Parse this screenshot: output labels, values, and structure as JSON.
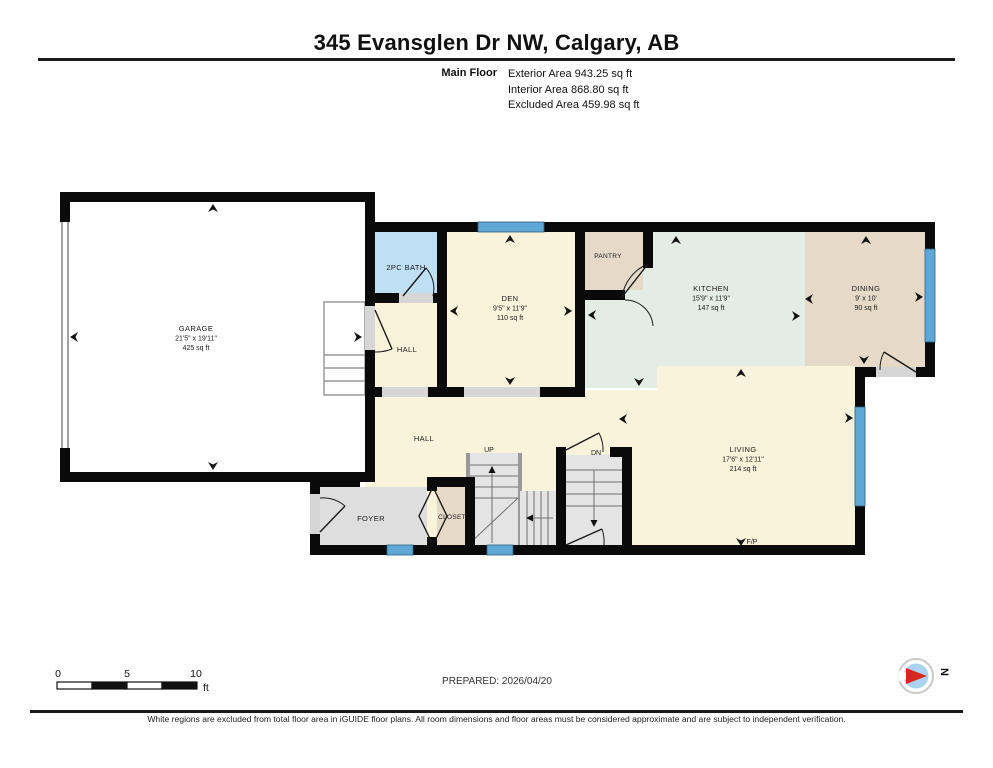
{
  "header": {
    "title": "345 Evansglen Dr NW, Calgary, AB",
    "floor_label": "Main Floor",
    "stats": [
      "Exterior Area 943.25 sq ft",
      "Interior Area 868.80 sq ft",
      "Excluded Area 459.98 sq ft"
    ]
  },
  "rooms": {
    "garage": {
      "name": "GARAGE",
      "dims": "21'5\" x 19'11\"",
      "area": "425 sq ft"
    },
    "bath": {
      "name": "2PC BATH"
    },
    "hall_upper": {
      "name": "HALL"
    },
    "den": {
      "name": "DEN",
      "dims": "9'5\" x 11'9\"",
      "area": "110 sq ft"
    },
    "pantry": {
      "name": "PANTRY"
    },
    "kitchen": {
      "name": "KITCHEN",
      "dims": "15'9\" x 11'9\"",
      "area": "147 sq ft"
    },
    "dining": {
      "name": "DINING",
      "dims": "9' x 10'",
      "area": "90 sq ft"
    },
    "living": {
      "name": "LIVING",
      "dims": "17'6\" x 12'11\"",
      "area": "214 sq ft"
    },
    "hall_lower": {
      "name": "HALL"
    },
    "foyer": {
      "name": "FOYER"
    },
    "closet": {
      "name": "CLOSET"
    },
    "stairs_up": {
      "name": "UP"
    },
    "stairs_dn": {
      "name": "DN"
    },
    "fireplace": {
      "name": "F/P"
    }
  },
  "scale_bar": {
    "tick0": "0",
    "tick5": "5",
    "tick10": "10",
    "unit": "ft"
  },
  "prepared": "PREPARED: 2026/04/20",
  "compass": {
    "north_label": "N"
  },
  "footer": {
    "disclaimer": "White regions are excluded from total floor area in iGUIDE floor plans. All room dimensions and floor areas must be considered approximate and are subject to independent verification."
  },
  "colors": {
    "wall": "#0a0a0a",
    "floor_cream": "#faf3db",
    "bath_blue": "#bfdff4",
    "kitchen_mint": "#e3ece5",
    "tan_beige": "#e6d9c8",
    "foyer_gray": "#dedede",
    "stair_gray": "#e4e4e4",
    "window_blue": "#5fa8d5",
    "compass_blue": "#a9d3ef",
    "compass_red": "#d42a1e"
  }
}
